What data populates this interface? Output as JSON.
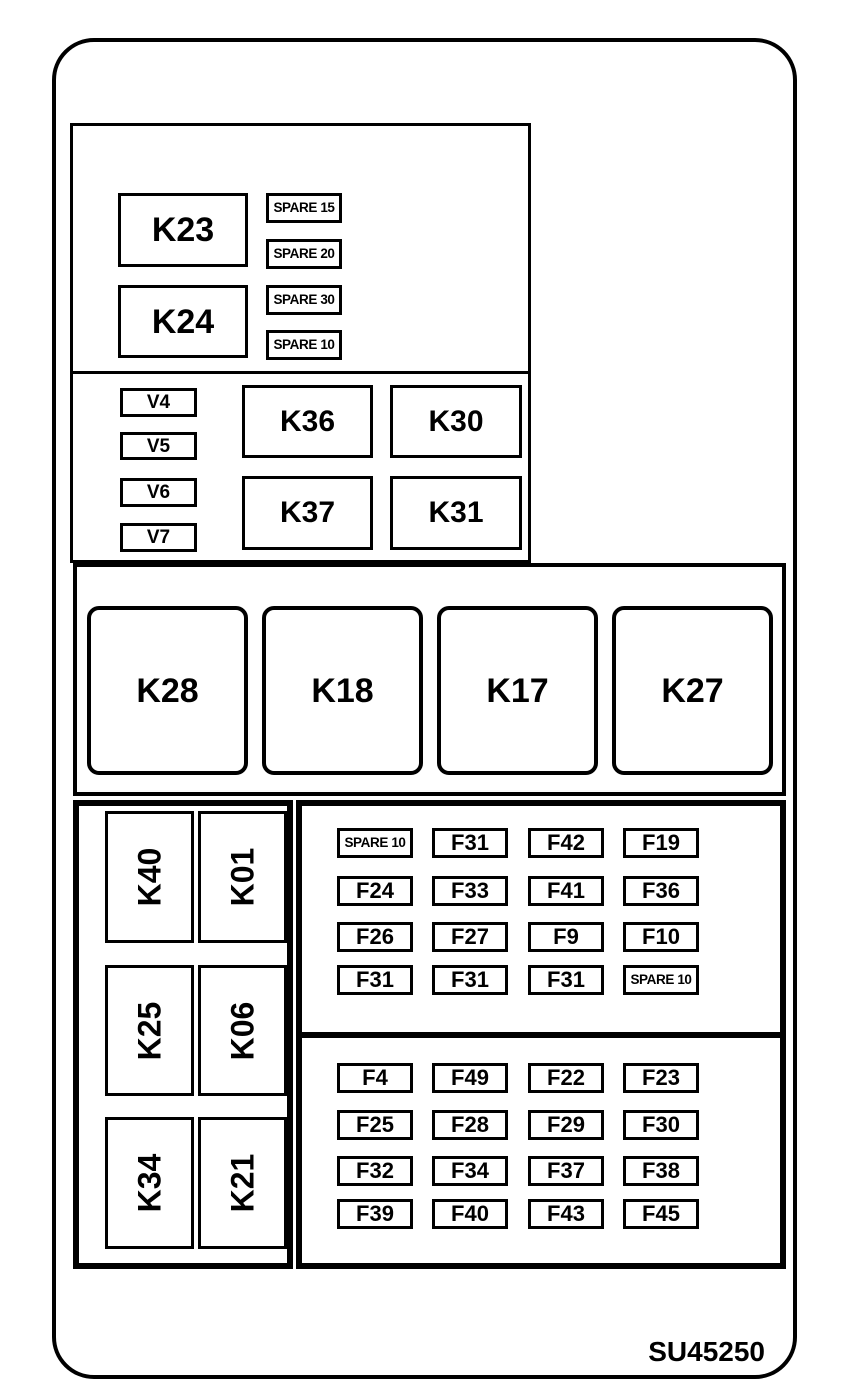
{
  "footer": {
    "code": "SU45250"
  },
  "top_section": {
    "relays": [
      "K23",
      "K24"
    ],
    "spares": [
      "SPARE 15",
      "SPARE 20",
      "SPARE 30",
      "SPARE 10"
    ]
  },
  "relay_section": {
    "v_modules": [
      "V4",
      "V5",
      "V6",
      "V7"
    ],
    "relays": [
      "K36",
      "K30",
      "K37",
      "K31"
    ]
  },
  "main_relays": [
    "K28",
    "K18",
    "K17",
    "K27"
  ],
  "side_relays": [
    "K40",
    "K01",
    "K25",
    "K06",
    "K34",
    "K21"
  ],
  "fuse_grid_upper": [
    [
      "SPARE 10",
      "F31",
      "F42",
      "F19"
    ],
    [
      "F24",
      "F33",
      "F41",
      "F36"
    ],
    [
      "F26",
      "F27",
      "F9",
      "F10"
    ],
    [
      "F31",
      "F31",
      "F31",
      "SPARE 10"
    ]
  ],
  "fuse_grid_lower": [
    [
      "F4",
      "F49",
      "F22",
      "F23"
    ],
    [
      "F25",
      "F28",
      "F29",
      "F30"
    ],
    [
      "F32",
      "F34",
      "F37",
      "F38"
    ],
    [
      "F39",
      "F40",
      "F43",
      "F45"
    ]
  ],
  "colors": {
    "line": "#000000",
    "background": "#ffffff"
  }
}
